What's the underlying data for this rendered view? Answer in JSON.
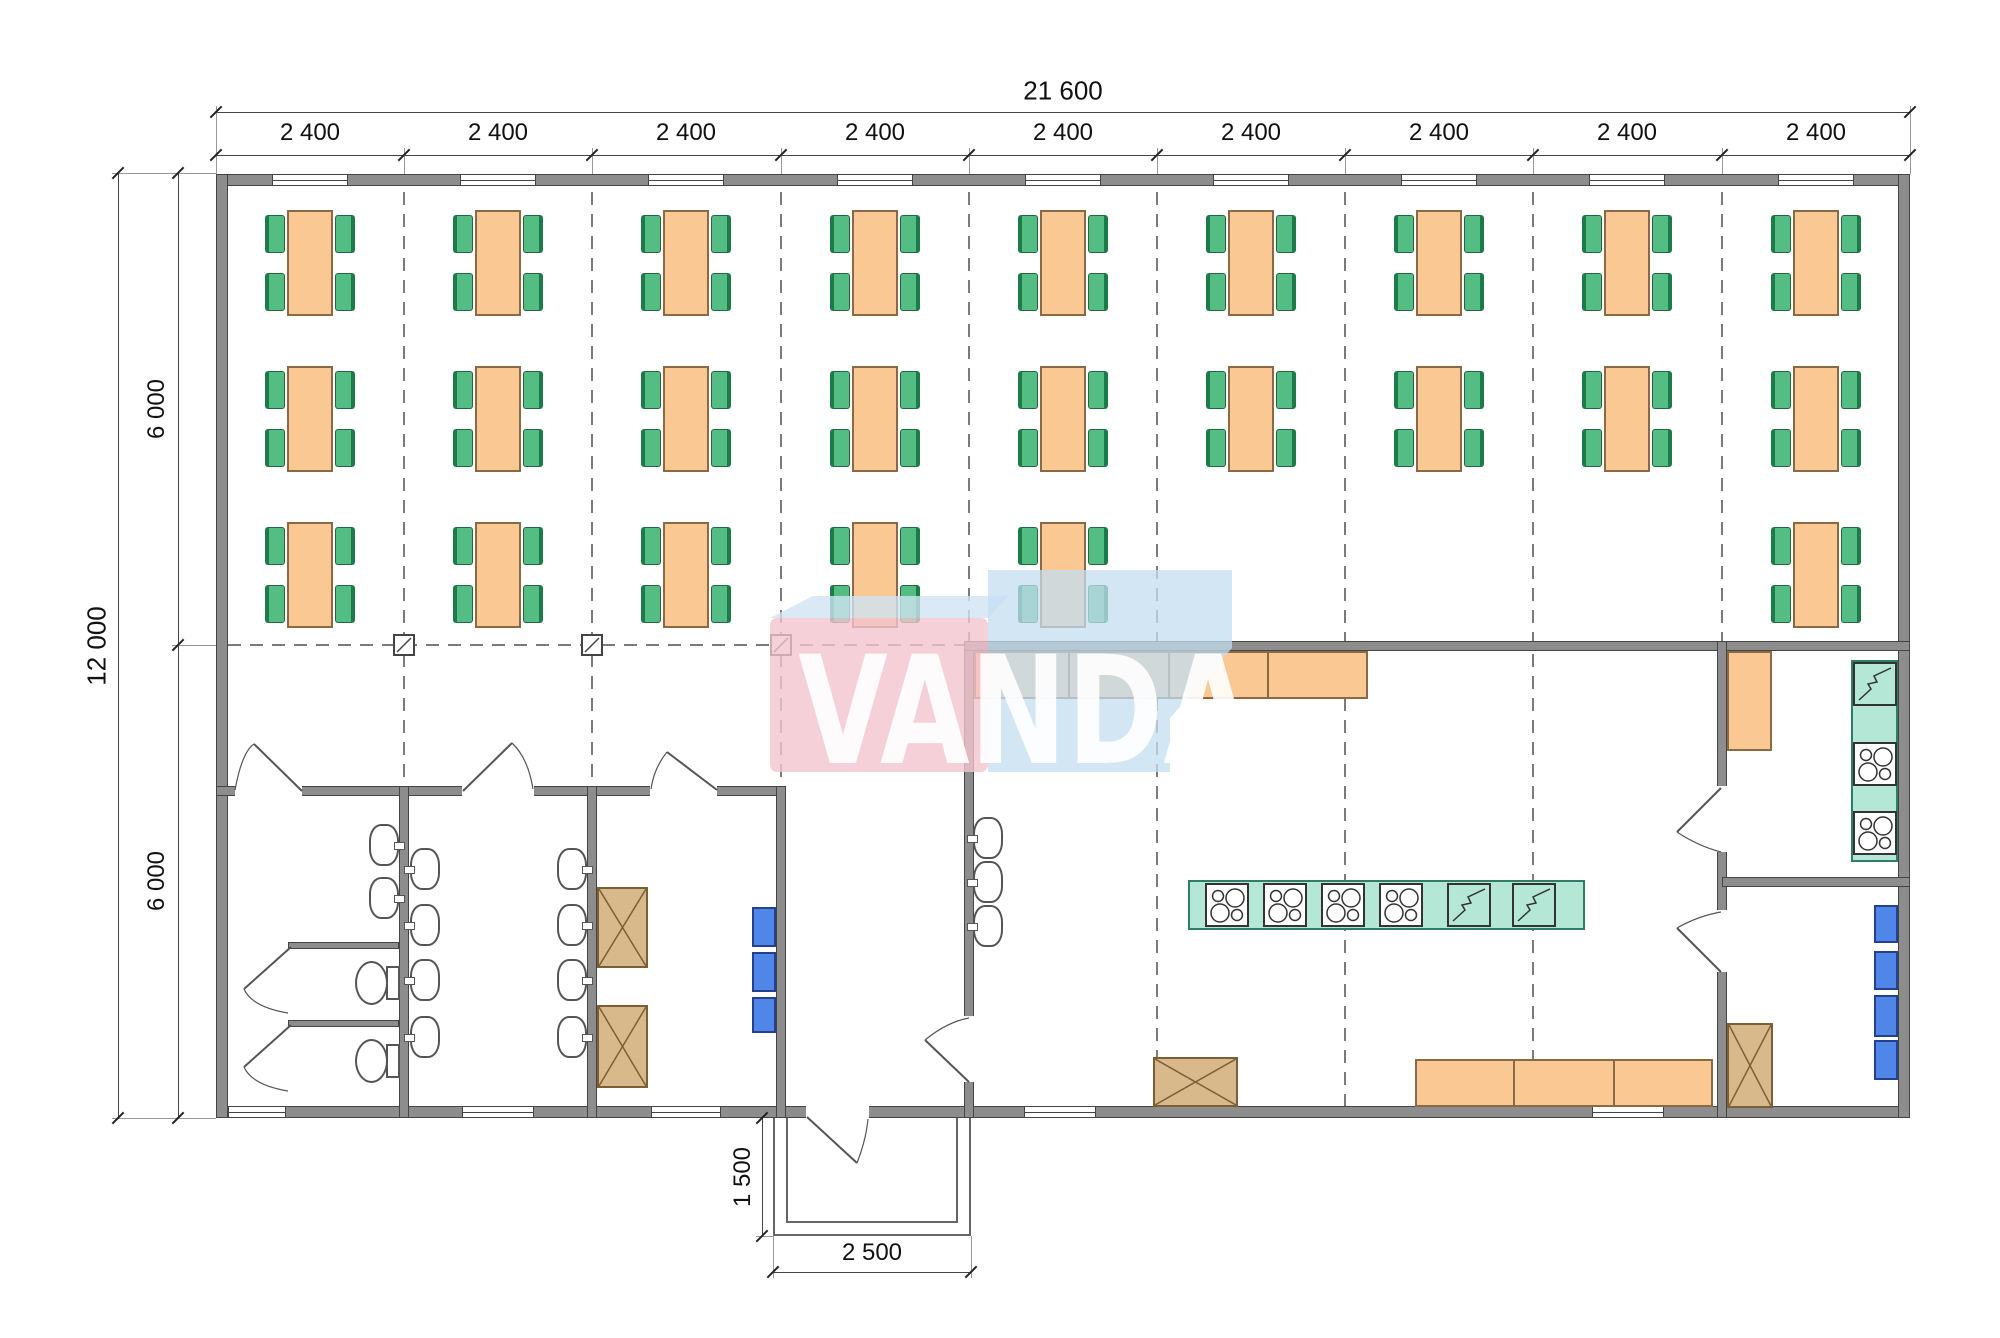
{
  "watermark": {
    "text": "VANDA",
    "pink_color": "#f3c4cf",
    "blue_color": "#c3ddf0",
    "top_face_color": "#cfe4f2",
    "text_color": "#ffffff"
  },
  "colors": {
    "wall": "#8d8d8d",
    "table_orange": "#f9c893",
    "chair_green": "#53bd83",
    "counter_teal": "#b4e7d6",
    "cabinet_tan": "#d7b98c",
    "appliance_blue": "#4f86e8",
    "dash_gray": "#7b7b7b"
  },
  "dimensions": {
    "total_width_label": "21 600",
    "bay_labels": [
      "2 400",
      "2 400",
      "2 400",
      "2 400",
      "2 400",
      "2 400",
      "2 400",
      "2 400",
      "2 400"
    ],
    "total_height_label": "12 000",
    "half_height_labels": [
      "6 000",
      "6 000"
    ],
    "porch_depth_label": "1 500",
    "porch_width_label": "2 500"
  },
  "plan": {
    "ticks_x": [
      216,
      404,
      592,
      781,
      969,
      1157,
      1345,
      1533,
      1722,
      1910
    ],
    "bay_centers": [
      310,
      498,
      686,
      875,
      1063,
      1251,
      1439,
      1627,
      1816
    ],
    "walls": [
      {
        "x": 216,
        "y": 174,
        "w": 1694,
        "h": 12
      },
      {
        "x": 216,
        "y": 1106,
        "w": 1694,
        "h": 12
      },
      {
        "x": 216,
        "y": 174,
        "w": 12,
        "h": 944
      },
      {
        "x": 1898,
        "y": 174,
        "w": 12,
        "h": 944
      },
      {
        "x": 216,
        "y": 786,
        "w": 570,
        "h": 10
      },
      {
        "x": 399,
        "y": 786,
        "w": 10,
        "h": 332
      },
      {
        "x": 587,
        "y": 786,
        "w": 10,
        "h": 332
      },
      {
        "x": 776,
        "y": 786,
        "w": 10,
        "h": 332
      },
      {
        "x": 964,
        "y": 641,
        "w": 10,
        "h": 477
      },
      {
        "x": 964,
        "y": 641,
        "w": 946,
        "h": 10
      },
      {
        "x": 1717,
        "y": 641,
        "w": 10,
        "h": 477
      },
      {
        "x": 1722,
        "y": 877,
        "w": 188,
        "h": 10
      },
      {
        "x": 288,
        "y": 942,
        "w": 111,
        "h": 7
      },
      {
        "x": 288,
        "y": 1020,
        "w": 111,
        "h": 7
      }
    ],
    "wall_gaps": [
      {
        "x": 235,
        "y": 785,
        "w": 67,
        "h": 12
      },
      {
        "x": 462,
        "y": 785,
        "w": 72,
        "h": 12
      },
      {
        "x": 650,
        "y": 785,
        "w": 67,
        "h": 12
      },
      {
        "x": 963,
        "y": 1016,
        "w": 12,
        "h": 66
      },
      {
        "x": 1716,
        "y": 786,
        "w": 12,
        "h": 66
      },
      {
        "x": 1716,
        "y": 910,
        "w": 12,
        "h": 62
      },
      {
        "x": 806,
        "y": 1105,
        "w": 63,
        "h": 14
      }
    ],
    "windows_top": {
      "y": 174,
      "h": 12,
      "w": 76,
      "centers": [
        310,
        498,
        686,
        875,
        1063,
        1251,
        1439,
        1627,
        1816
      ]
    },
    "windows_bottom": {
      "y": 1106,
      "h": 12,
      "items": [
        {
          "c": 257,
          "w": 58
        },
        {
          "c": 498,
          "w": 72
        },
        {
          "c": 686,
          "w": 70
        },
        {
          "c": 1060,
          "w": 72
        },
        {
          "c": 1628,
          "w": 72
        }
      ]
    },
    "grid_v": [
      {
        "x": 404,
        "y1": 192,
        "y2": 786
      },
      {
        "x": 592,
        "y1": 192,
        "y2": 786
      },
      {
        "x": 781,
        "y1": 192,
        "y2": 786
      },
      {
        "x": 969,
        "y1": 192,
        "y2": 641
      },
      {
        "x": 1157,
        "y1": 192,
        "y2": 1106
      },
      {
        "x": 1345,
        "y1": 192,
        "y2": 1106
      },
      {
        "x": 1533,
        "y1": 192,
        "y2": 1106
      },
      {
        "x": 1722,
        "y1": 192,
        "y2": 641
      }
    ],
    "grid_h": {
      "y": 645,
      "x1": 228,
      "x2": 964
    },
    "columns": [
      {
        "x": 404,
        "y": 645
      },
      {
        "x": 592,
        "y": 645
      },
      {
        "x": 781,
        "y": 645
      }
    ],
    "dining_rows": [
      {
        "y": 210,
        "bays": [
          0,
          1,
          2,
          3,
          4,
          5,
          6,
          7,
          8
        ]
      },
      {
        "y": 366,
        "bays": [
          0,
          1,
          2,
          3,
          4,
          5,
          6,
          7,
          8
        ]
      },
      {
        "y": 522,
        "bays": [
          0,
          1,
          2,
          3,
          4,
          8
        ]
      }
    ],
    "table": {
      "w": 46,
      "h": 106,
      "chair_w": 20,
      "chair_h": 38
    },
    "sinks": [
      {
        "cx": 384,
        "cy": 845,
        "side": "right"
      },
      {
        "cx": 384,
        "cy": 898,
        "side": "right"
      },
      {
        "cx": 425,
        "cy": 869,
        "side": "left"
      },
      {
        "cx": 425,
        "cy": 925,
        "side": "left"
      },
      {
        "cx": 425,
        "cy": 980,
        "side": "left"
      },
      {
        "cx": 425,
        "cy": 1037,
        "side": "left"
      },
      {
        "cx": 572,
        "cy": 869,
        "side": "right"
      },
      {
        "cx": 572,
        "cy": 925,
        "side": "right"
      },
      {
        "cx": 572,
        "cy": 980,
        "side": "right"
      },
      {
        "cx": 572,
        "cy": 1037,
        "side": "right"
      },
      {
        "cx": 988,
        "cy": 838,
        "side": "left"
      },
      {
        "cx": 988,
        "cy": 882,
        "side": "left"
      },
      {
        "cx": 988,
        "cy": 926,
        "side": "left"
      }
    ],
    "toilets": [
      {
        "cx": 372,
        "cy": 983
      },
      {
        "cx": 372,
        "cy": 1061
      }
    ],
    "counters_orange": [
      {
        "x": 974,
        "y": 651,
        "w": 394,
        "h": 48,
        "div": [
          1068,
          1168,
          1267
        ]
      },
      {
        "x": 1415,
        "y": 1059,
        "w": 298,
        "h": 48,
        "div": [
          1513,
          1613
        ]
      },
      {
        "x": 1727,
        "y": 651,
        "w": 45,
        "h": 100,
        "div": []
      }
    ],
    "counters_teal": [
      {
        "x": 1188,
        "y": 880,
        "w": 397,
        "h": 50
      },
      {
        "x": 1851,
        "y": 660,
        "w": 47,
        "h": 202
      }
    ],
    "stoves": [
      {
        "x": 1205,
        "y": 883
      },
      {
        "x": 1263,
        "y": 883
      },
      {
        "x": 1321,
        "y": 883
      },
      {
        "x": 1379,
        "y": 883
      },
      {
        "x": 1853,
        "y": 742
      },
      {
        "x": 1853,
        "y": 811
      }
    ],
    "zigzag_appliances": [
      {
        "x": 1447,
        "y": 883
      },
      {
        "x": 1512,
        "y": 883
      },
      {
        "x": 1853,
        "y": 662
      }
    ],
    "tan_boxes": [
      {
        "x": 597,
        "y": 887,
        "w": 51,
        "h": 81
      },
      {
        "x": 597,
        "y": 1005,
        "w": 51,
        "h": 83
      },
      {
        "x": 1153,
        "y": 1057,
        "w": 85,
        "h": 50
      },
      {
        "x": 1727,
        "y": 1023,
        "w": 46,
        "h": 85
      }
    ],
    "blue_boxes": [
      {
        "x": 752,
        "y": 907,
        "w": 24,
        "h": 40
      },
      {
        "x": 752,
        "y": 952,
        "w": 24,
        "h": 40
      },
      {
        "x": 752,
        "y": 997,
        "w": 24,
        "h": 36
      },
      {
        "x": 1874,
        "y": 905,
        "w": 24,
        "h": 38
      },
      {
        "x": 1874,
        "y": 951,
        "w": 24,
        "h": 39
      },
      {
        "x": 1874,
        "y": 995,
        "w": 24,
        "h": 42
      },
      {
        "x": 1874,
        "y": 1040,
        "w": 24,
        "h": 40
      }
    ],
    "porch": {
      "outer": {
        "x": 773,
        "y": 1118,
        "w": 198,
        "h": 118
      },
      "inner": {
        "x": 786,
        "y": 1118,
        "w": 172,
        "h": 105
      }
    },
    "doors": [
      {
        "name": "door-wc-left",
        "leaf": "M302,791 L254,744",
        "arc": "M235,790 Q242,752 254,744"
      },
      {
        "name": "door-washroom",
        "leaf": "M463,791 L512,743",
        "arc": "M512,743 Q528,758 533,789"
      },
      {
        "name": "door-wc-right",
        "leaf": "M717,790 L667,752",
        "arc": "M667,752 Q654,768 651,789"
      },
      {
        "name": "door-stall-1",
        "leaf": "M291,947 L244,989",
        "arc": "M244,989 Q252,1007 288,1013"
      },
      {
        "name": "door-stall-2",
        "leaf": "M291,1025 L244,1067",
        "arc": "M244,1067 Q252,1085 288,1091"
      },
      {
        "name": "door-entrance",
        "leaf": "M807,1117 L857,1163",
        "arc": "M857,1163 Q866,1140 868,1119"
      },
      {
        "name": "door-vestibule-kitchen",
        "leaf": "M969,1082 L925,1040",
        "arc": "M969,1018 Q947,1022 925,1040"
      },
      {
        "name": "door-kitchen-room-upper",
        "leaf": "M1721,788 L1677,832",
        "arc": "M1721,852 Q1698,846 1677,832"
      },
      {
        "name": "door-kitchen-room-lower",
        "leaf": "M1721,972 L1677,928",
        "arc": "M1721,912 Q1698,916 1677,928"
      }
    ],
    "dim_lines": [
      {
        "name": "top-total",
        "x": 216,
        "y": 112,
        "w": 1694,
        "h": 1
      },
      {
        "name": "top-bays",
        "x": 216,
        "y": 155,
        "w": 1694,
        "h": 1
      },
      {
        "name": "left-total",
        "x": 118,
        "y": 173,
        "w": 1,
        "h": 945
      },
      {
        "name": "left-halves",
        "x": 178,
        "y": 173,
        "w": 1,
        "h": 945
      },
      {
        "name": "porch-depth",
        "x": 762,
        "y": 1118,
        "w": 1,
        "h": 118
      },
      {
        "name": "porch-width",
        "x": 773,
        "y": 1272,
        "w": 198,
        "h": 1
      }
    ],
    "ext_lines": [
      {
        "x": 216,
        "y": 106,
        "w": 1,
        "h": 68
      },
      {
        "x": 1910,
        "y": 106,
        "w": 1,
        "h": 68
      },
      {
        "x": 404,
        "y": 148,
        "w": 1,
        "h": 26
      },
      {
        "x": 592,
        "y": 148,
        "w": 1,
        "h": 26
      },
      {
        "x": 781,
        "y": 148,
        "w": 1,
        "h": 26
      },
      {
        "x": 969,
        "y": 148,
        "w": 1,
        "h": 26
      },
      {
        "x": 1157,
        "y": 148,
        "w": 1,
        "h": 26
      },
      {
        "x": 1345,
        "y": 148,
        "w": 1,
        "h": 26
      },
      {
        "x": 1533,
        "y": 148,
        "w": 1,
        "h": 26
      },
      {
        "x": 1722,
        "y": 148,
        "w": 1,
        "h": 26
      },
      {
        "x": 112,
        "y": 173,
        "w": 104,
        "h": 1
      },
      {
        "x": 172,
        "y": 645,
        "w": 44,
        "h": 1
      },
      {
        "x": 112,
        "y": 1118,
        "w": 104,
        "h": 1
      },
      {
        "x": 756,
        "y": 1236,
        "w": 17,
        "h": 1
      },
      {
        "x": 773,
        "y": 1236,
        "w": 1,
        "h": 42
      },
      {
        "x": 971,
        "y": 1236,
        "w": 1,
        "h": 42
      }
    ],
    "slashes": [
      {
        "x": 216,
        "y": 112
      },
      {
        "x": 1910,
        "y": 112
      },
      {
        "x": 216,
        "y": 155
      },
      {
        "x": 404,
        "y": 155
      },
      {
        "x": 592,
        "y": 155
      },
      {
        "x": 781,
        "y": 155
      },
      {
        "x": 969,
        "y": 155
      },
      {
        "x": 1157,
        "y": 155
      },
      {
        "x": 1345,
        "y": 155
      },
      {
        "x": 1533,
        "y": 155
      },
      {
        "x": 1722,
        "y": 155
      },
      {
        "x": 1910,
        "y": 155
      },
      {
        "x": 118,
        "y": 173
      },
      {
        "x": 118,
        "y": 1118
      },
      {
        "x": 178,
        "y": 173
      },
      {
        "x": 178,
        "y": 645
      },
      {
        "x": 178,
        "y": 1118
      },
      {
        "x": 762,
        "y": 1118
      },
      {
        "x": 762,
        "y": 1236
      },
      {
        "x": 773,
        "y": 1272
      },
      {
        "x": 971,
        "y": 1272
      }
    ],
    "dim_labels": [
      {
        "bind": "dimensions.total_width_label",
        "x": 1063,
        "y": 91,
        "size": 26,
        "rot": false
      },
      {
        "bind": "dimensions.bay_labels.0",
        "x": 310,
        "y": 133,
        "size": 24,
        "rot": false
      },
      {
        "bind": "dimensions.bay_labels.1",
        "x": 498,
        "y": 133,
        "size": 24,
        "rot": false
      },
      {
        "bind": "dimensions.bay_labels.2",
        "x": 686,
        "y": 133,
        "size": 24,
        "rot": false
      },
      {
        "bind": "dimensions.bay_labels.3",
        "x": 875,
        "y": 133,
        "size": 24,
        "rot": false
      },
      {
        "bind": "dimensions.bay_labels.4",
        "x": 1063,
        "y": 133,
        "size": 24,
        "rot": false
      },
      {
        "bind": "dimensions.bay_labels.5",
        "x": 1251,
        "y": 133,
        "size": 24,
        "rot": false
      },
      {
        "bind": "dimensions.bay_labels.6",
        "x": 1439,
        "y": 133,
        "size": 24,
        "rot": false
      },
      {
        "bind": "dimensions.bay_labels.7",
        "x": 1627,
        "y": 133,
        "size": 24,
        "rot": false
      },
      {
        "bind": "dimensions.bay_labels.8",
        "x": 1816,
        "y": 133,
        "size": 24,
        "rot": false
      },
      {
        "bind": "dimensions.total_height_label",
        "x": 97,
        "y": 646,
        "size": 26,
        "rot": true
      },
      {
        "bind": "dimensions.half_height_labels.0",
        "x": 157,
        "y": 409,
        "size": 24,
        "rot": true
      },
      {
        "bind": "dimensions.half_height_labels.1",
        "x": 157,
        "y": 881,
        "size": 24,
        "rot": true
      },
      {
        "bind": "dimensions.porch_depth_label",
        "x": 743,
        "y": 1177,
        "size": 24,
        "rot": true
      },
      {
        "bind": "dimensions.porch_width_label",
        "x": 872,
        "y": 1253,
        "size": 24,
        "rot": false
      }
    ]
  }
}
